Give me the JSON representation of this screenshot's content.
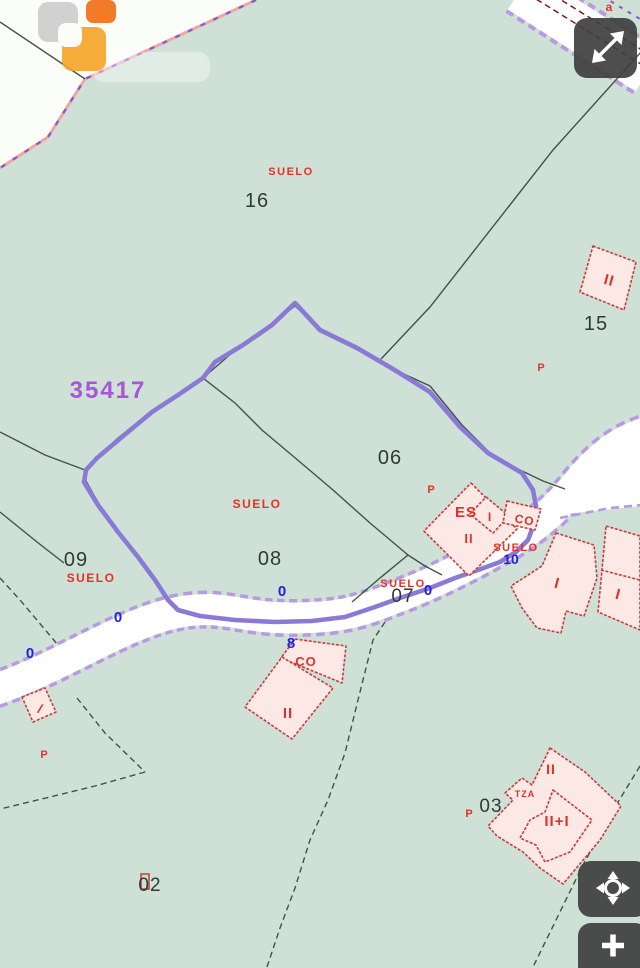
{
  "map": {
    "ref_number": "35417",
    "road_letter": {
      "t": "a",
      "x": 609,
      "y": 10,
      "size": 12
    },
    "labels": {
      "suelo": [
        {
          "t": "SUELO",
          "x": 291,
          "y": 175,
          "size": 11
        },
        {
          "t": "SUELO",
          "x": 257,
          "y": 508,
          "size": 12
        },
        {
          "t": "SUELO",
          "x": 91,
          "y": 582,
          "size": 12
        },
        {
          "t": "SUELO",
          "x": 403,
          "y": 587,
          "size": 11
        },
        {
          "t": "SUELO",
          "x": 516,
          "y": 551,
          "size": 11
        }
      ],
      "parcels": [
        {
          "t": "16",
          "x": 257,
          "y": 207,
          "size": 20
        },
        {
          "t": "15",
          "x": 596,
          "y": 330,
          "size": 20
        },
        {
          "t": "06",
          "x": 390,
          "y": 464,
          "size": 20
        },
        {
          "t": "08",
          "x": 270,
          "y": 565,
          "size": 20
        },
        {
          "t": "09",
          "x": 76,
          "y": 566,
          "size": 20
        },
        {
          "t": "07",
          "x": 403,
          "y": 602,
          "size": 19
        },
        {
          "t": "02",
          "x": 150,
          "y": 891,
          "size": 19
        },
        {
          "t": "03",
          "x": 491,
          "y": 812,
          "size": 19
        }
      ],
      "addresses": [
        {
          "t": "0",
          "x": 282,
          "y": 596,
          "size": 15
        },
        {
          "t": "8",
          "x": 291,
          "y": 648,
          "size": 15
        },
        {
          "t": "0",
          "x": 118,
          "y": 622,
          "size": 15
        },
        {
          "t": "0",
          "x": 30,
          "y": 658,
          "size": 15
        },
        {
          "t": "0",
          "x": 428,
          "y": 595,
          "size": 15
        },
        {
          "t": "10",
          "x": 511,
          "y": 564,
          "size": 14
        }
      ],
      "buildings": [
        {
          "t": "II",
          "x": 608,
          "y": 285,
          "size": 15,
          "rotate": 15
        },
        {
          "t": "ES",
          "x": 466,
          "y": 517,
          "size": 15
        },
        {
          "t": "I",
          "x": 490,
          "y": 521,
          "size": 12
        },
        {
          "t": "II",
          "x": 469,
          "y": 543,
          "size": 13
        },
        {
          "t": "CO",
          "x": 524,
          "y": 524,
          "size": 12,
          "rotate": 10
        },
        {
          "t": "I",
          "x": 556,
          "y": 588,
          "size": 15,
          "rotate": 15
        },
        {
          "t": "I",
          "x": 617,
          "y": 599,
          "size": 15,
          "rotate": 15
        },
        {
          "t": "CO",
          "x": 306,
          "y": 666,
          "size": 13
        },
        {
          "t": "II",
          "x": 288,
          "y": 718,
          "size": 15
        },
        {
          "t": "/",
          "x": 39,
          "y": 713,
          "size": 13,
          "rotate": 20
        },
        {
          "t": "II",
          "x": 551,
          "y": 774,
          "size": 14
        },
        {
          "t": "II+I",
          "x": 557,
          "y": 826,
          "size": 15
        },
        {
          "t": "TZA",
          "x": 525,
          "y": 797,
          "size": 9
        }
      ],
      "p_marks": [
        {
          "t": "P",
          "x": 431,
          "y": 493,
          "size": 11
        },
        {
          "t": "P",
          "x": 541,
          "y": 371,
          "size": 11
        },
        {
          "t": "P",
          "x": 44,
          "y": 758,
          "size": 11
        },
        {
          "t": "P",
          "x": 469,
          "y": 817,
          "size": 11
        }
      ]
    },
    "colors": {
      "background": "#cfe0d7",
      "outside_area": "#fbfef8",
      "parcel_line": "#37453d",
      "building_fill": "#fce9e5",
      "building_stroke": "#cc3b39",
      "road_fill": "#ffffff",
      "road_edge": "#b79ae1",
      "selection": "#8b7ad5",
      "boundary_pink": "#f2a5a3",
      "boundary_purple": "#7e5cd0",
      "label_red": "#e63226",
      "label_blue": "#2222dd",
      "ref_purple": "#a855d8"
    }
  },
  "controls": {
    "expand": {
      "icon": "expand-diagonal-icon"
    },
    "pan": {
      "icon": "pan-crosshair-icon"
    },
    "zoom_in": {
      "icon": "plus-icon",
      "label": "+"
    }
  }
}
